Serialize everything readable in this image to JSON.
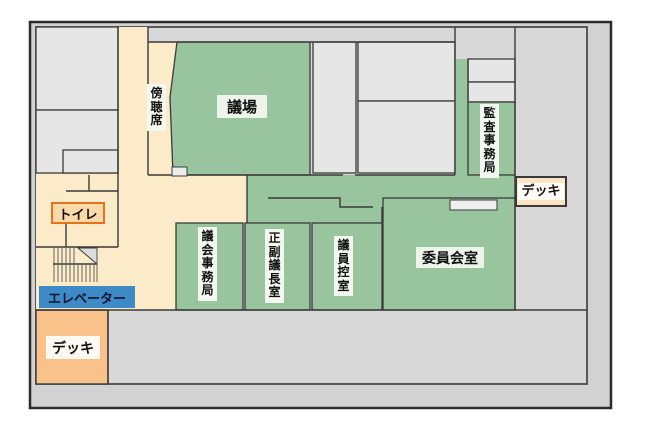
{
  "floorplan": {
    "labels": {
      "gijo": "議場",
      "bochoseki": "傍聴席",
      "kansa_jimukyoku": "監査事務局",
      "gikai_jimukyoku": "議会事務局",
      "seifuku_gicho_shitsu": "正副議長室",
      "giin_hikaeshitsu": "議員控室",
      "iinkai_shitsu": "委員会室",
      "toilet": "トイレ",
      "elevator": "エレベーター",
      "deck_left": "デッキ",
      "deck_right": "デッキ"
    },
    "colors": {
      "room_green": "#98c59e",
      "corridor_cream": "#fcebc9",
      "deck_orange": "#f9c28a",
      "deck_right_fill": "#fce4c4",
      "elevator_blue": "#3d8ac6",
      "toilet_border_orange": "#e5731d",
      "room_gray": "#e6e6e6",
      "margin_gray": "#d2d2d2",
      "wall_dark": "#3a3a3a",
      "label_bg": "#f3f7f0"
    }
  }
}
